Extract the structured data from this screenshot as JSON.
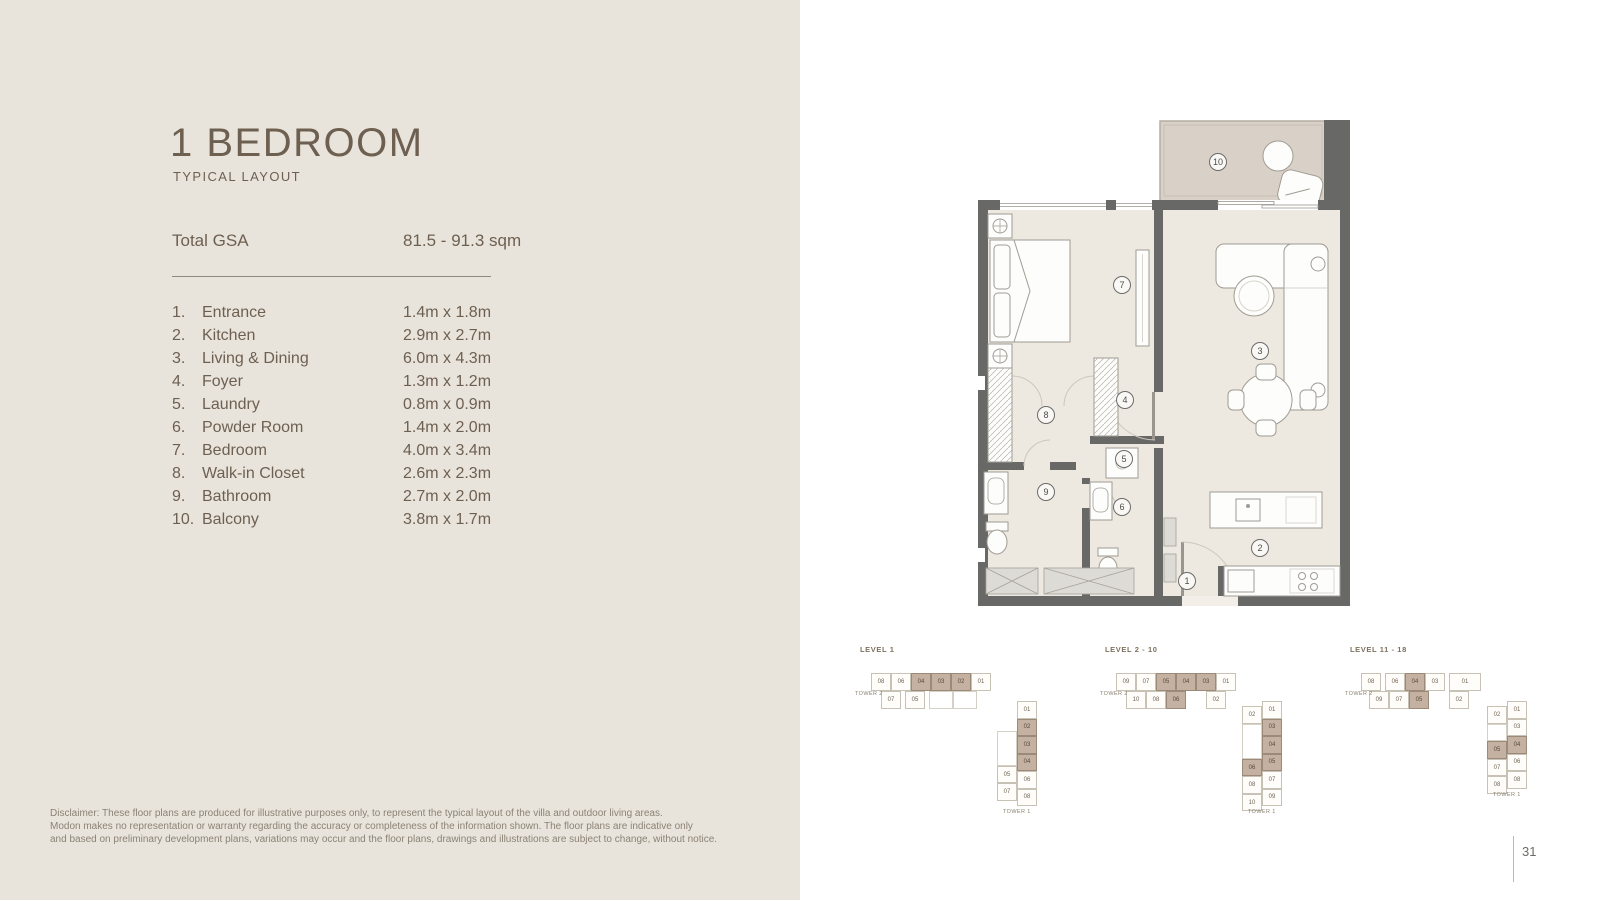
{
  "header": {
    "title": "1 BEDROOM",
    "subtitle": "TYPICAL LAYOUT"
  },
  "gsa": {
    "label": "Total GSA",
    "value": "81.5 - 91.3 sqm"
  },
  "rooms": [
    {
      "no": "1.",
      "name": "Entrance",
      "dims": "1.4m x 1.8m"
    },
    {
      "no": "2.",
      "name": "Kitchen",
      "dims": "2.9m x 2.7m"
    },
    {
      "no": "3.",
      "name": "Living & Dining",
      "dims": "6.0m x 4.3m"
    },
    {
      "no": "4.",
      "name": "Foyer",
      "dims": "1.3m x 1.2m"
    },
    {
      "no": "5.",
      "name": "Laundry",
      "dims": "0.8m x 0.9m"
    },
    {
      "no": "6.",
      "name": "Powder Room",
      "dims": "1.4m x 2.0m"
    },
    {
      "no": "7.",
      "name": "Bedroom",
      "dims": "4.0m x 3.4m"
    },
    {
      "no": "8.",
      "name": "Walk-in Closet",
      "dims": "2.6m x 2.3m"
    },
    {
      "no": "9.",
      "name": "Bathroom",
      "dims": "2.7m x 2.0m"
    },
    {
      "no": "10.",
      "name": "Balcony",
      "dims": "3.8m x 1.7m"
    }
  ],
  "disclaimer": {
    "text": "Disclaimer: These floor plans are produced for illustrative purposes only, to represent the typical layout of the villa and outdoor living areas.\nModon makes no representation or warranty regarding the accuracy or completeness of the information shown. The floor plans are indicative only\nand based on preliminary development plans, variations may occur and the floor plans, drawings and illustrations are subject to change, without notice."
  },
  "page": {
    "number": "31"
  },
  "plan": {
    "markers": [
      {
        "n": "1",
        "x": 209,
        "y": 463
      },
      {
        "n": "2",
        "x": 282,
        "y": 430
      },
      {
        "n": "3",
        "x": 282,
        "y": 233
      },
      {
        "n": "4",
        "x": 147,
        "y": 282
      },
      {
        "n": "5",
        "x": 146,
        "y": 341
      },
      {
        "n": "6",
        "x": 144,
        "y": 389
      },
      {
        "n": "7",
        "x": 144,
        "y": 167
      },
      {
        "n": "8",
        "x": 68,
        "y": 297
      },
      {
        "n": "9",
        "x": 68,
        "y": 374
      },
      {
        "n": "10",
        "x": 240,
        "y": 44
      }
    ]
  },
  "colors": {
    "left_bg": "#e8e4dc",
    "wall": "#686866",
    "floor": "#ede8e0",
    "balcony_floor": "#d9d1c8",
    "highlight_taupe": "#c4b1a1",
    "text_brown": "#6e6051"
  },
  "keyplans": [
    {
      "label": "LEVEL 1",
      "tower2": {
        "label": "TOWER 2",
        "rows": [
          [
            {
              "t": "08"
            },
            {
              "t": "06"
            },
            {
              "t": "04",
              "hl": 1
            },
            {
              "t": "03",
              "hl": 1
            },
            {
              "t": "02",
              "hl": 1
            },
            {
              "t": "01"
            }
          ],
          [
            {
              "t": "07",
              "c": 0.5
            },
            {
              "t": "05",
              "c": 1.7
            },
            {
              "t": "",
              "c": 2.9,
              "w": 1.2
            },
            {
              "t": "",
              "c": 4.1,
              "w": 1.2
            }
          ]
        ]
      },
      "tower1": {
        "label": "TOWER 1",
        "right": [
          {
            "t": "01",
            "r": 0
          },
          {
            "t": "02",
            "r": 1,
            "hl": 1
          },
          {
            "t": "03",
            "r": 2,
            "hl": 1
          },
          {
            "t": "04",
            "r": 3,
            "hl": 1
          },
          {
            "t": "06",
            "r": 4
          },
          {
            "t": "08",
            "r": 5
          }
        ],
        "left": [
          {
            "t": "",
            "r": 1.7,
            "h": 2
          },
          {
            "t": "05",
            "r": 3.7
          },
          {
            "t": "07",
            "r": 4.7
          }
        ]
      }
    },
    {
      "label": "LEVEL 2 - 10",
      "tower2": {
        "label": "TOWER 2",
        "rows": [
          [
            {
              "t": "09"
            },
            {
              "t": "07"
            },
            {
              "t": "05",
              "hl": 1
            },
            {
              "t": "04",
              "hl": 1
            },
            {
              "t": "03",
              "hl": 1
            },
            {
              "t": "01"
            }
          ],
          [
            {
              "t": "10",
              "c": 0.5
            },
            {
              "t": "08",
              "c": 1.5
            },
            {
              "t": "06",
              "c": 2.5,
              "hl": 1
            },
            {
              "t": "02",
              "c": 4.5
            }
          ]
        ]
      },
      "tower1": {
        "label": "TOWER 1",
        "right": [
          {
            "t": "01",
            "r": 0
          },
          {
            "t": "03",
            "r": 1,
            "hl": 1
          },
          {
            "t": "04",
            "r": 2,
            "hl": 1
          },
          {
            "t": "05",
            "r": 3,
            "hl": 1
          },
          {
            "t": "07",
            "r": 4
          },
          {
            "t": "09",
            "r": 5
          }
        ],
        "left": [
          {
            "t": "02",
            "r": 0.3
          },
          {
            "t": "",
            "r": 1.3,
            "h": 2
          },
          {
            "t": "06",
            "r": 3.3,
            "hl": 1
          },
          {
            "t": "08",
            "r": 4.3
          },
          {
            "t": "10",
            "r": 5.3
          }
        ]
      }
    },
    {
      "label": "LEVEL 11 - 18",
      "tower2": {
        "label": "TOWER 2",
        "rows": [
          [
            {
              "t": "08"
            },
            {
              "t": "06",
              "c": 1.2
            },
            {
              "t": "04",
              "c": 2.2,
              "hl": 1
            },
            {
              "t": "03",
              "c": 3.2
            },
            {
              "t": "01",
              "c": 4.4,
              "w": 1.6
            }
          ],
          [
            {
              "t": "09",
              "c": 0.4
            },
            {
              "t": "07",
              "c": 1.4
            },
            {
              "t": "05",
              "c": 2.4,
              "hl": 1
            },
            {
              "t": "02",
              "c": 4.4
            }
          ]
        ]
      },
      "tower1": {
        "label": "TOWER 1",
        "right": [
          {
            "t": "01",
            "r": 0
          },
          {
            "t": "03",
            "r": 1
          },
          {
            "t": "04",
            "r": 2,
            "hl": 1
          },
          {
            "t": "06",
            "r": 3
          },
          {
            "t": "08",
            "r": 4
          }
        ],
        "left": [
          {
            "t": "02",
            "r": 0.3
          },
          {
            "t": "",
            "r": 1.3
          },
          {
            "t": "05",
            "r": 2.3,
            "hl": 1
          },
          {
            "t": "07",
            "r": 3.3
          },
          {
            "t": "08",
            "r": 4.3
          }
        ]
      }
    }
  ]
}
